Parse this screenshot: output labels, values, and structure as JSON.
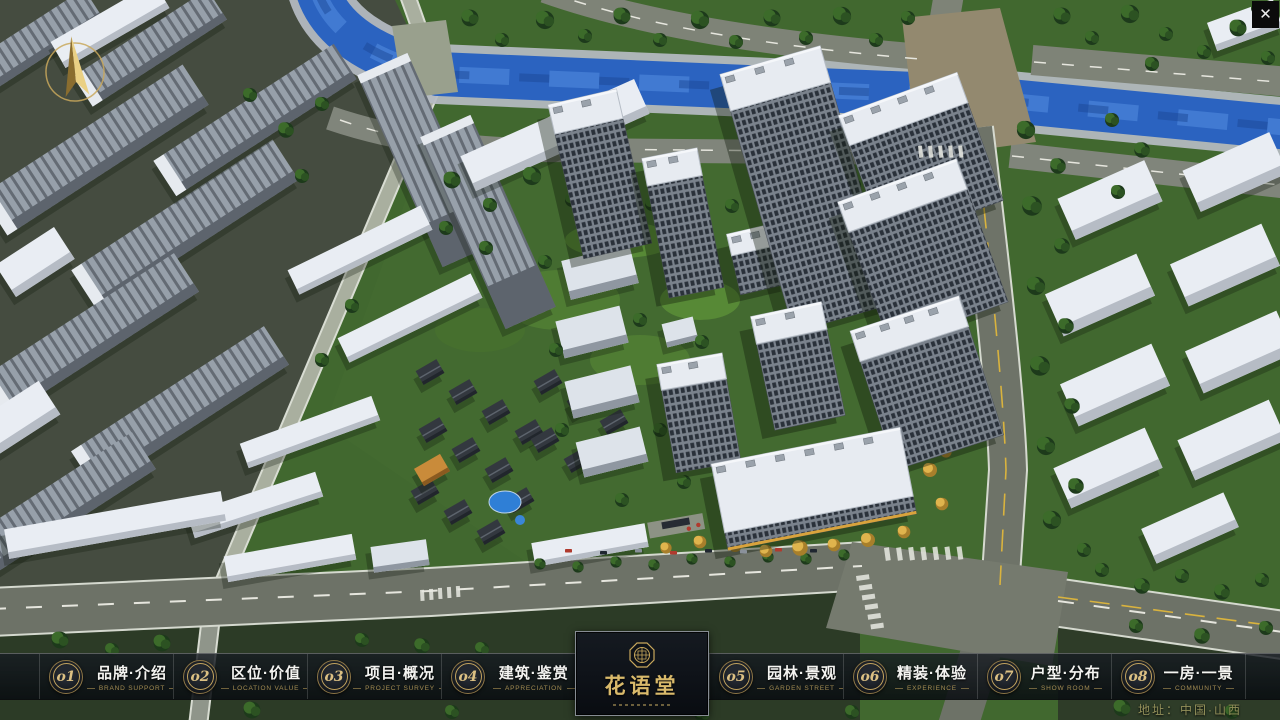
{
  "theme": {
    "accent_gold": "#c3a468",
    "text_gold_dim": "#a48c52",
    "bar_bg": "#10151c",
    "panel_bg": "#0c1017",
    "river_blue": "#2b63c0",
    "ground_green": "#3f672f",
    "road_grey": "#6d7267"
  },
  "icons": {
    "close": "✕",
    "compass": "compass-north-arrow",
    "seal": "octagonal-seal"
  },
  "logo": {
    "title": "花语堂"
  },
  "nav": {
    "items": [
      {
        "num": "o1",
        "label_cn": "品牌·介绍",
        "label_en": "BRAND SUPPORT"
      },
      {
        "num": "o2",
        "label_cn": "区位·价值",
        "label_en": "LOCATION VALUE"
      },
      {
        "num": "o3",
        "label_cn": "项目·概况",
        "label_en": "PROJECT SURVEY"
      },
      {
        "num": "o4",
        "label_cn": "建筑·鉴赏",
        "label_en": "APPRECIATION"
      },
      {
        "num": "o5",
        "label_cn": "园林·景观",
        "label_en": "GARDEN STREET"
      },
      {
        "num": "o6",
        "label_cn": "精装·体验",
        "label_en": "EXPERIENCE"
      },
      {
        "num": "o7",
        "label_cn": "户型·分布",
        "label_en": "SHOW ROOM"
      },
      {
        "num": "o8",
        "label_cn": "一房·一景",
        "label_en": "COMMUNITY"
      }
    ]
  },
  "footer": {
    "address": "地址：中国·山西"
  }
}
